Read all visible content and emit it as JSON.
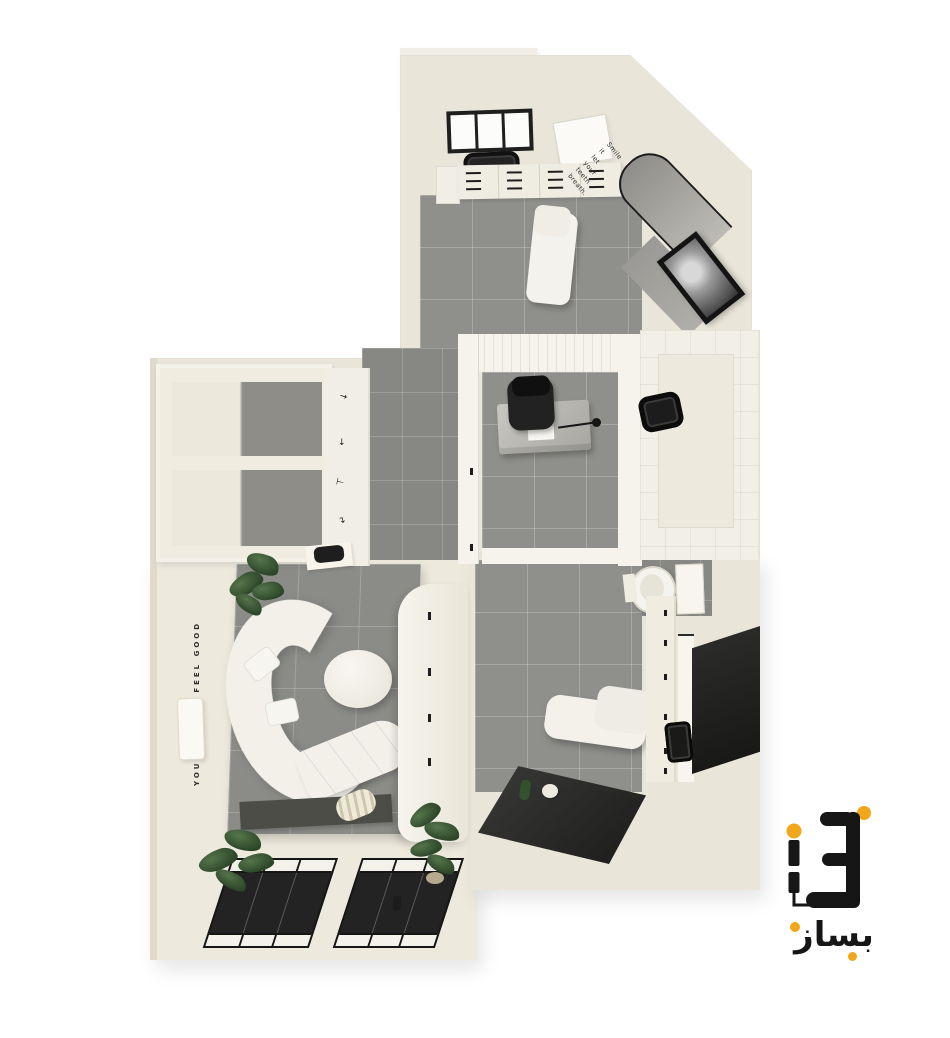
{
  "scene": {
    "width": 950,
    "height": 1038,
    "background": "#FFFFFF"
  },
  "palette": {
    "wall_beige": "#E9E5D8",
    "wall_light": "#F1EEE5",
    "floor_gray": "#8F8F8B",
    "rug_gray": "#8B8C88",
    "dark_glass": "#232323",
    "frame_black": "#161616",
    "furniture_white": "#F2F0E9",
    "plant_green": "#3C5837",
    "logo_black": "#161616",
    "logo_orange": "#F2A71B"
  },
  "texts": {
    "smile_quote_lines": [
      "Smile",
      "it",
      "let",
      "your",
      "teeth",
      "breath."
    ],
    "left_wall_quote": "YOU DESERVE FEEL GOOD",
    "wall_marks": [
      "↘",
      "↓",
      "⊢",
      "↴",
      "∴∵"
    ]
  },
  "logo": {
    "wordmark": "بساز"
  }
}
